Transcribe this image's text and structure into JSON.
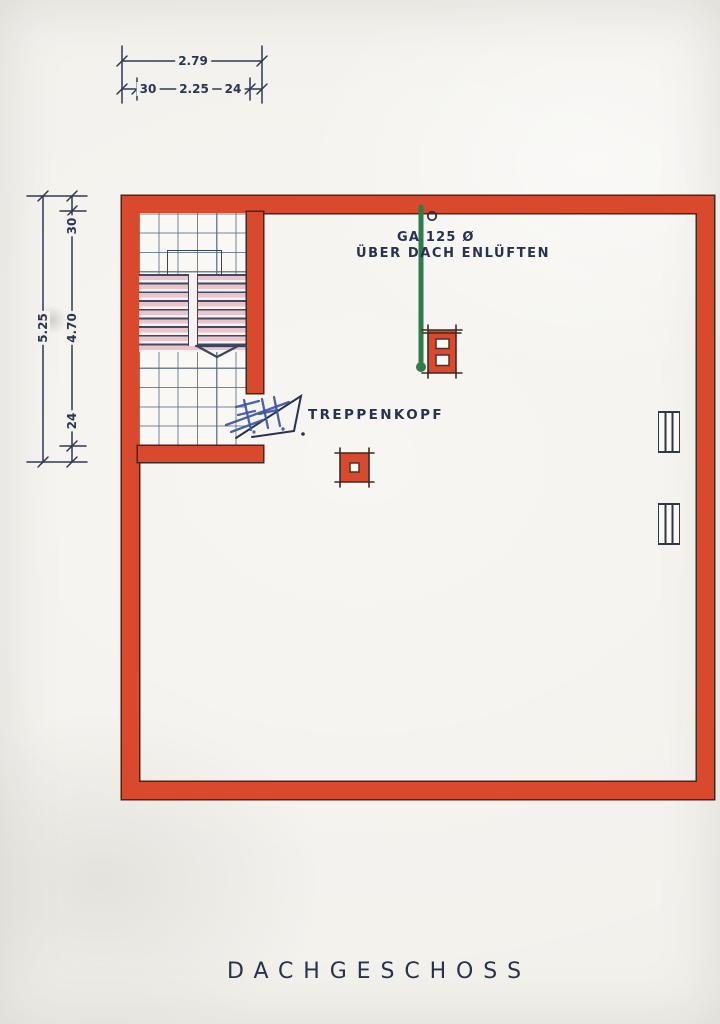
{
  "sheet": {
    "floor_title": "DACHGESCHOSS"
  },
  "dimensions": {
    "top": {
      "total": "2.79",
      "seg_left": "30",
      "seg_mid": "2.25",
      "seg_right": "24"
    },
    "left": {
      "total": "5.25",
      "seg_top": "30",
      "seg_mid": "4.70",
      "seg_bottom": "24"
    }
  },
  "annotations": {
    "vent_label_line1": "GA 125 Ø",
    "vent_label_line2": "ÜBER DACH ENLÜFTEN",
    "stair_label": "TREPPENKOPF",
    "handwritten_initials": "F.H."
  },
  "colors": {
    "paper": "#f3f1ec",
    "wall_red": "#d8492d",
    "wall_outline": "#40291f",
    "ink_navy": "#27324e",
    "grid_blue": "#5d6f86",
    "stair_pink": "#e9c4cb",
    "vent_green": "#2e7b4c",
    "pen_blue": "#3d55a4"
  }
}
